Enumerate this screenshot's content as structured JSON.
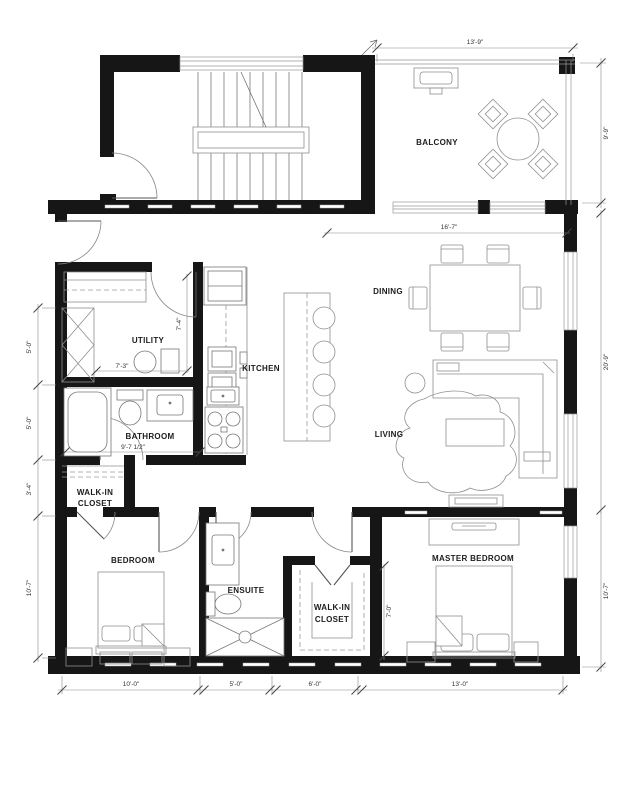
{
  "rooms": {
    "balcony": "BALCONY",
    "dining": "DINING",
    "kitchen": "KITCHEN",
    "utility": "UTILITY",
    "bathroom": "BATHROOM",
    "living": "LIVING",
    "bedroom": "BEDROOM",
    "ensuite": "ENSUITE",
    "master_bedroom": "MASTER BEDROOM",
    "walk_in_line1": "WALK-IN",
    "walk_in_line2": "CLOSET"
  },
  "dims": {
    "balcony_width": "13'-9\"",
    "balcony_depth": "9'-9\"",
    "great_room_width": "16'-7\"",
    "great_room_depth": "20'-9\"",
    "utility_depth": "7'-4\"",
    "utility_width": "7'-3\"",
    "bathroom_width": "9'-7 1/2\"",
    "left_upper": "5'-0\"",
    "left_mid": "5'-0\"",
    "left_closet": "3'-4\"",
    "left_bedroom_depth": "10'-7\"",
    "closet2_depth": "7'-0\"",
    "master_depth": "10'-7\"",
    "bedroom_width": "10'-0\"",
    "ensuite_width": "5'-0\"",
    "closet2_width": "6'-0\"",
    "master_width": "13'-0\""
  }
}
